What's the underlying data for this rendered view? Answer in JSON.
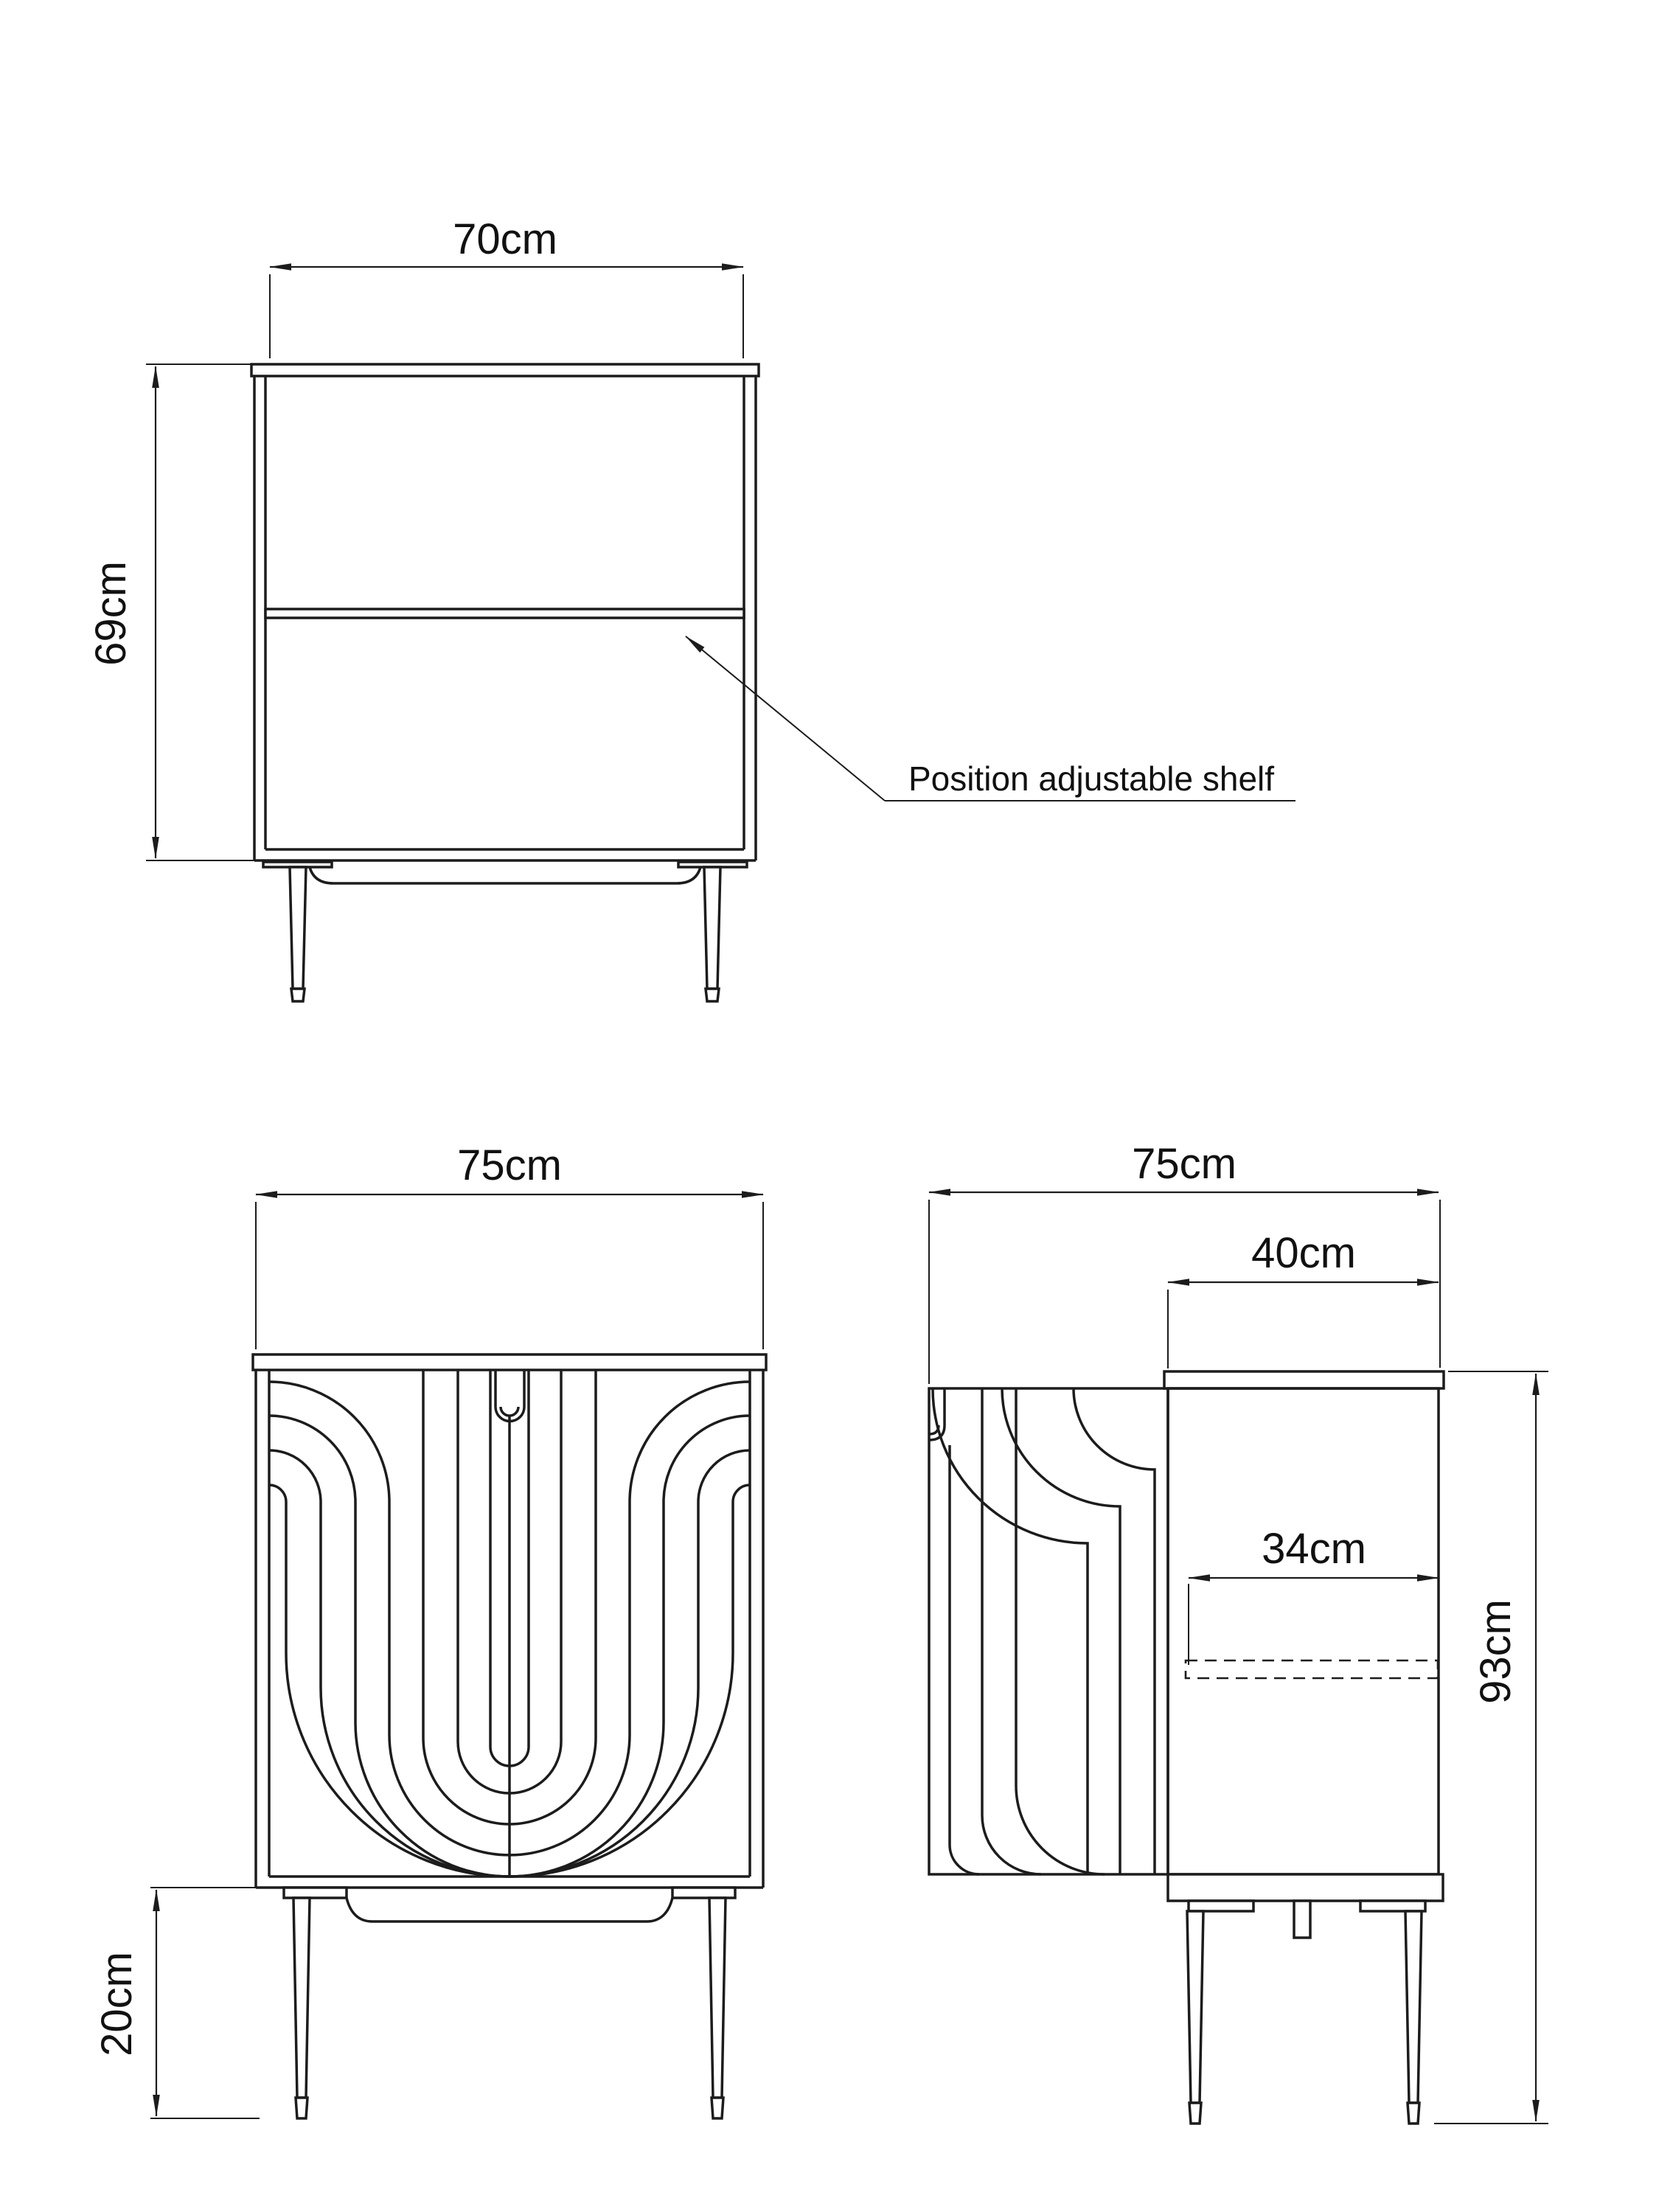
{
  "drawing": {
    "type": "furniture dimension drawing",
    "annotation": {
      "shelf_note": "Position adjustable shelf"
    },
    "top_view": {
      "width_label": "70cm",
      "height_label": "69cm"
    },
    "front_view": {
      "width_label": "75cm",
      "leg_height_label": "20cm"
    },
    "side_view": {
      "width_label": "75cm",
      "depth_label": "40cm",
      "shelf_depth_label": "34cm",
      "height_label": "93cm"
    },
    "colors": {
      "line": "#1c1c1c",
      "background": "#ffffff",
      "text": "#111111"
    }
  }
}
